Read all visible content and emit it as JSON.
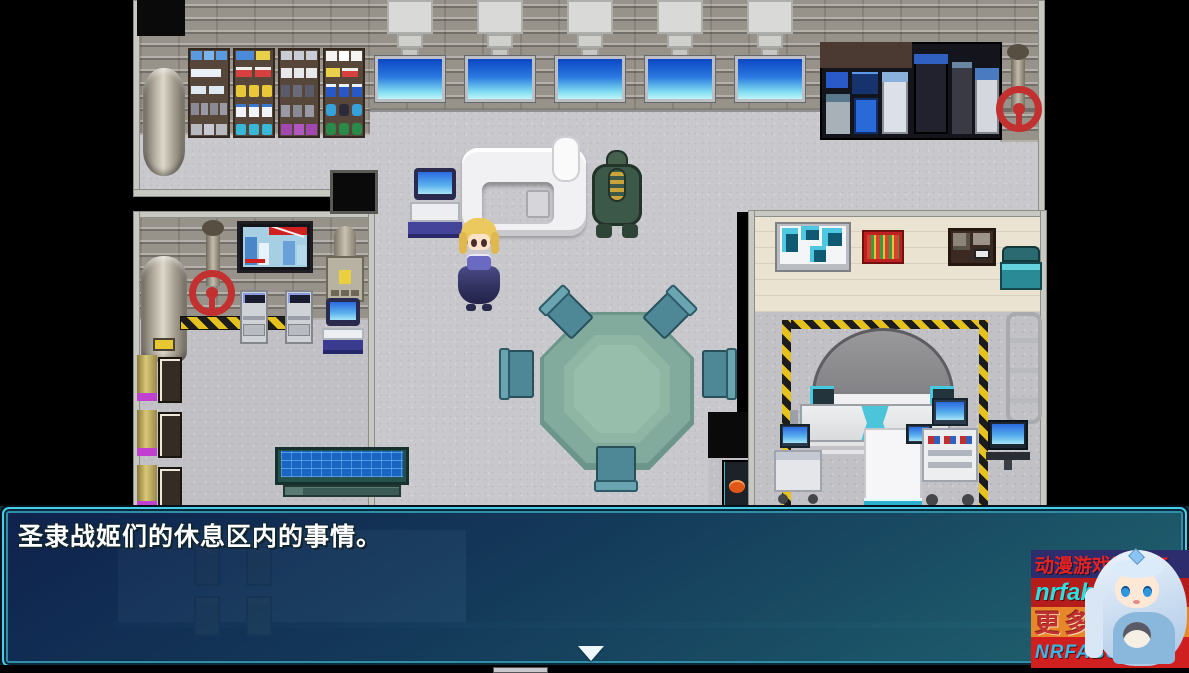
{
  "dialogue": {
    "text": "圣隶战姬们的休息区内的事情。"
  },
  "watermark": {
    "line1": "动漫游戏资源库",
    "line2": "nrfabu.com",
    "line3": "更多资源",
    "line4": "NRFABU.COM"
  },
  "colors": {
    "dialog_border_cyan": "#47cdea",
    "dialog_bg_top": "#0f214e",
    "dialog_bg_bottom": "#267480",
    "screen_blue_top": "#0b46c4",
    "screen_blue_bottom": "#bff4f8",
    "hazard_yellow": "#e6c21e",
    "table_teal": "#7fa697",
    "valve_red": "#c23030",
    "medical_wall_beige": "#eae3d2",
    "floor_gray": "#c9c9cd",
    "watermark_row1_bg": "#2d2d6d",
    "watermark_row1_text": "#e62222",
    "watermark_row2_bg": "#b51d1d",
    "watermark_row2_text": "#2ae0e0",
    "watermark_row3_bg": "#e8872a",
    "watermark_row3_text": "#c23030",
    "watermark_row4_bg": "#cf1f1f",
    "watermark_row4_text": "#38b8e8"
  }
}
